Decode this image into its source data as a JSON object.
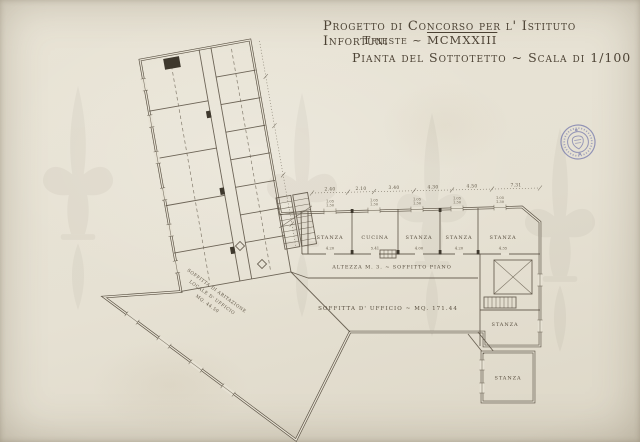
{
  "document": {
    "title_line1": "Progetto di Concorso per l' Istituto Infortuni",
    "title_line2_city": "Trieste ~ ",
    "title_line2_year": "MCMXXIII",
    "title_line3": "Pianta del Sottotetto ~  Scala di 1/100"
  },
  "plan": {
    "rooms_row": [
      {
        "label": "STANZA",
        "dim": "4.20"
      },
      {
        "label": "CUCINA",
        "dim": "5.41"
      },
      {
        "label": "STANZA",
        "dim": "4.00"
      },
      {
        "label": "STANZA",
        "dim": "4.20"
      },
      {
        "label": "STANZA",
        "dim": "4.35"
      }
    ],
    "corridor_note": "ALTEZZA M. 3. ~ SOFFITTO PIANO",
    "attic_label": "SOFFITTA D' UFFICIO ~ MQ. 171.44",
    "room_right_mid": "STANZA",
    "room_detached": "STANZA",
    "diagonal_note": [
      "SOFFITTA DI ABITAZIONE",
      "LOCALE D' UFFICIO",
      "MQ. 44.50"
    ],
    "top_dimensions": [
      "2.40",
      "2.10",
      "3.40",
      "4.30",
      "4.50",
      "7.31"
    ],
    "window_dimensions": [
      "1.05",
      "1.30"
    ]
  },
  "stamp": {
    "icon": "round-ink-stamp",
    "color": "#5d63a4"
  },
  "colors": {
    "paper": "#e7e2d4",
    "ink": "#5b5244",
    "stamp_blue": "#5d63a4"
  }
}
